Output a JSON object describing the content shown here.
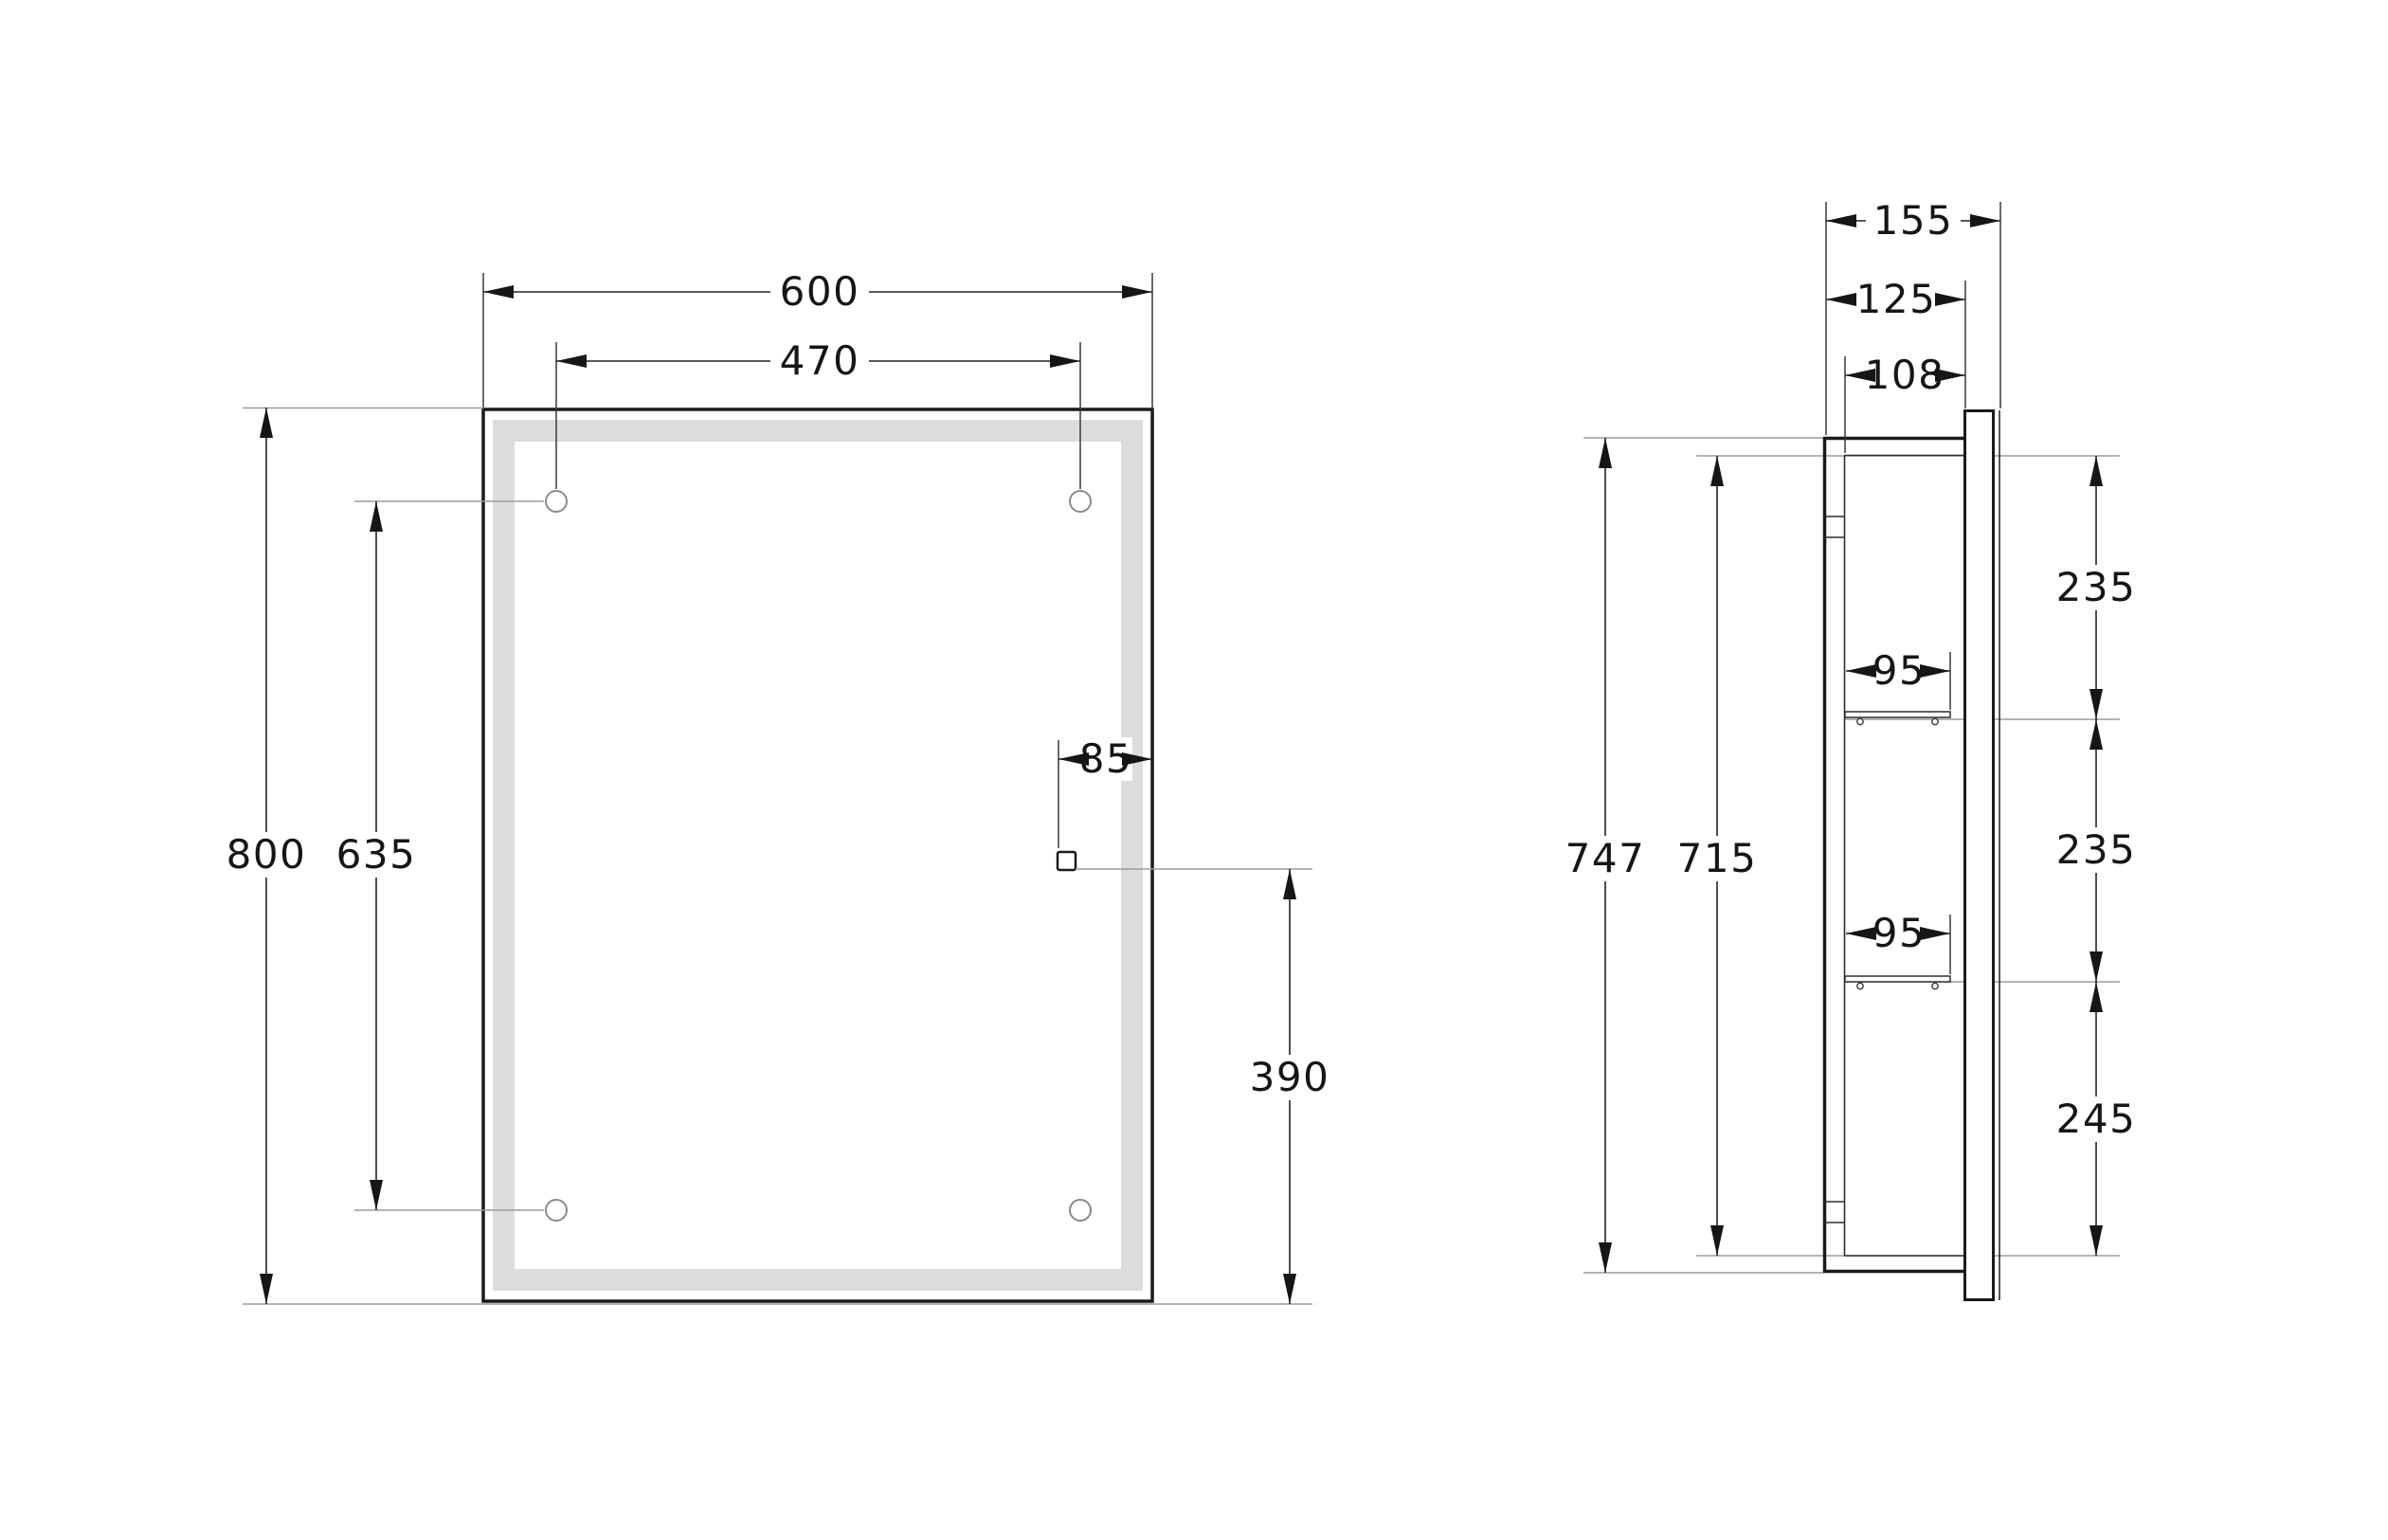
{
  "drawing": {
    "front_view": {
      "mirror_width": "600",
      "hole_spacing_horizontal": "470",
      "mirror_height": "800",
      "hole_spacing_vertical": "635",
      "sensor_offset_from_edge": "85",
      "sensor_height_from_bottom": "390"
    },
    "side_view": {
      "depth_total": "155",
      "depth_body": "125",
      "depth_inner": "108",
      "height_total": "747",
      "height_inner": "715",
      "shelf_depth_top": "95",
      "shelf_depth_bottom": "95",
      "gap_top_shelf": "235",
      "gap_middle_shelf": "235",
      "gap_bottom_shelf": "245"
    },
    "colors": {
      "line": "#1a1a1a",
      "reference_line": "#9c9c9c",
      "led_strip": "#dcdcdc"
    }
  }
}
